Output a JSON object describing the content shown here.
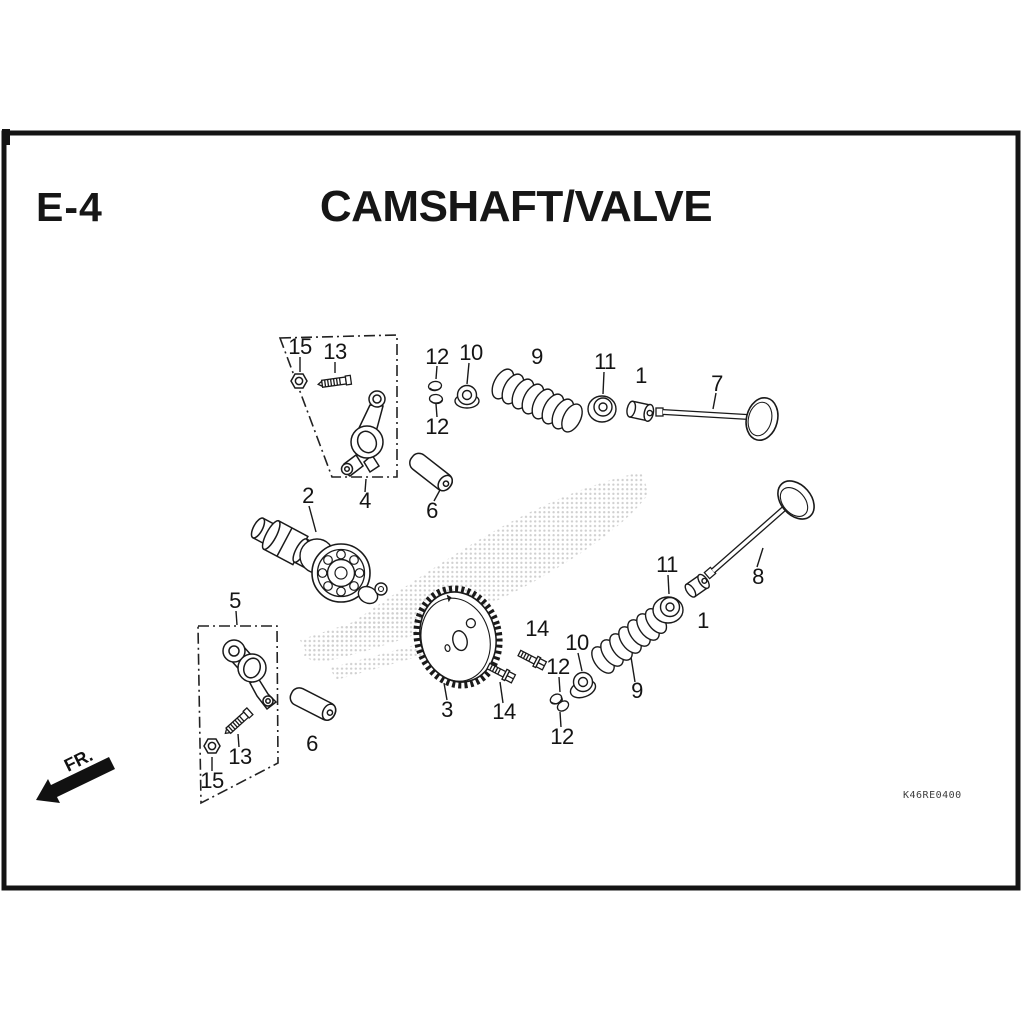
{
  "header": {
    "section_code": "E-4",
    "title": "CAMSHAFT/VALVE"
  },
  "diagram": {
    "type": "exploded-parts-diagram",
    "subject": "Camshaft and valve components",
    "callouts": [
      "15",
      "13",
      "12",
      "10",
      "9",
      "11",
      "1",
      "7",
      "12",
      "2",
      "4",
      "6",
      "5",
      "14",
      "10",
      "11",
      "12",
      "1",
      "8",
      "9",
      "3",
      "14",
      "12",
      "6",
      "13",
      "15"
    ],
    "watermark": "honda-wing-halftone"
  },
  "footer": {
    "orientation_label": "FR.",
    "diagram_code": "K46RE0400"
  }
}
